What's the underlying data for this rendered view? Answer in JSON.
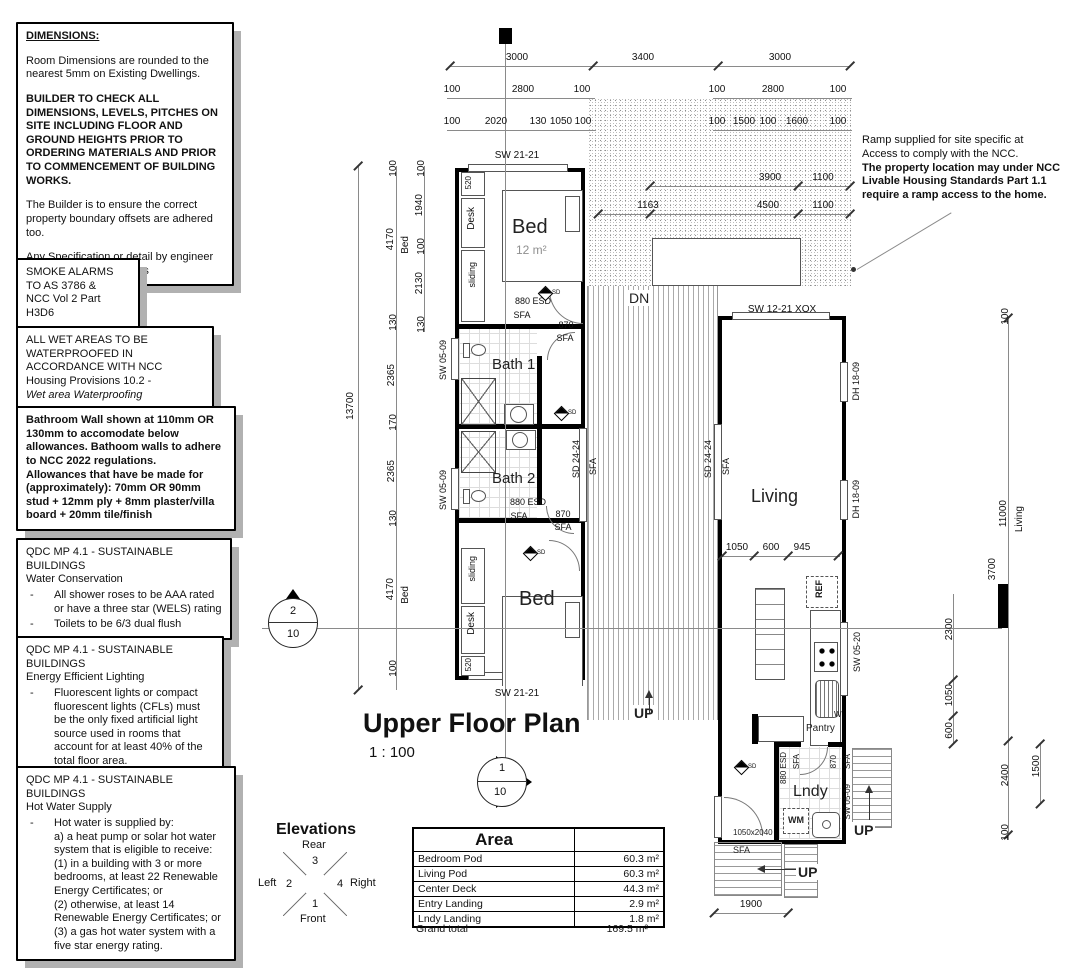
{
  "notes": {
    "bullet": "-",
    "dimensions": {
      "title": "DIMENSIONS:",
      "p1": "Room Dimensions are rounded to the nearest 5mm on Existing Dwellings.",
      "p2": "BUILDER TO CHECK ALL DIMENSIONS, LEVELS, PITCHES ON SITE INCLUDING FLOOR AND GROUND HEIGHTS PRIOR TO ORDERING MATERIALS AND PRIOR TO COMMENCEMENT OF BUILDING WORKS.",
      "p3": "The Builder is to ensure the correct property boundary offsets are adhered too.",
      "p4": "Any Specification or detail by engineer to supersede these plans"
    },
    "smoke": {
      "l1": "SMOKE ALARMS",
      "l2": "TO AS 3786 &",
      "l3": "NCC Vol 2 Part H3D6"
    },
    "wet": {
      "p1": "ALL WET AREAS TO BE WATERPROOFED IN ACCORDANCE WITH NCC Housing Provisions 10.2 -",
      "p2": "Wet area Waterproofing"
    },
    "bathwall": {
      "p1": "Bathroom Wall shown at 110mm OR 130mm to accomodate below allowances. Bathoom walls to adhere to NCC 2022 regulations.",
      "p2": "Allowances that have be made for (approximately): 70mm OR 90mm stud + 12mm ply + 8mm plaster/villa board + 20mm tile/finish"
    },
    "water": {
      "title": "QDC MP 4.1 - SUSTAINABLE BUILDINGS",
      "subtitle": "Water Conservation",
      "b1": "All shower roses to be AAA rated or have a three star (WELS) rating",
      "b2": "Toilets to be 6/3 dual flush"
    },
    "lighting": {
      "title": "QDC MP 4.1 - SUSTAINABLE BUILDINGS",
      "subtitle": "Energy Efficient Lighting",
      "b1": "Fluorescent lights or compact fluorescent lights (CFLs) must be the only fixed artificial light source used in rooms that account for at least 40% of the total floor area."
    },
    "hotwater": {
      "title": "QDC MP 4.1 - SUSTAINABLE BUILDINGS",
      "subtitle": "Hot Water Supply",
      "b1": "Hot water is supplied by:",
      "b2": "a) a heat pump or solar hot water system that is eligible to receive:",
      "b3": "(1) in a building with 3 or more bedrooms, at least 22 Renewable Energy Certificates; or",
      "b4": "(2) otherwise, at least 14 Renewable Energy Certificates; or",
      "b5": "(3) a gas hot water system with a five star energy rating."
    },
    "ramp": {
      "l1": "Ramp supplied for site specific at",
      "l2": "Access to comply with the NCC.",
      "l3": "The property location may under NCC",
      "l4": "Livable Housing Standards Part 1.1",
      "l5": "require a ramp access to the home."
    }
  },
  "title_block": {
    "title": "Upper Floor Plan",
    "scale": "1 : 100"
  },
  "elevations": {
    "title": "Elevations",
    "rear": "Rear",
    "front": "Front",
    "left": "Left",
    "right": "Right",
    "n1": "1",
    "n2": "2",
    "n3": "3",
    "n4": "4"
  },
  "area_table": {
    "header": "Area",
    "rows": [
      {
        "name": "Bedroom Pod",
        "value": "60.3 m²"
      },
      {
        "name": "Living Pod",
        "value": "60.3 m²"
      },
      {
        "name": "Center Deck",
        "value": "44.3 m²"
      },
      {
        "name": "Entry Landing",
        "value": "2.9 m²"
      },
      {
        "name": "Lndy Landing",
        "value": "1.8 m²"
      }
    ],
    "total_label": "Grand total",
    "total_value": "169.5 m²"
  },
  "markers": {
    "left_num": "2",
    "left_sheet": "10",
    "bottom_num": "1",
    "bottom_sheet": "10"
  },
  "labels": {
    "sw2121": "SW 21-21",
    "sw0509": "SW 05-09",
    "sw1221xox": "SW 12-21 XOX",
    "dh1809": "DH 18-09",
    "sw0520": "SW 05-20",
    "sd2424": "SD 24-24",
    "sfa": "SFA",
    "esd": "880 ESD",
    "d870": "870",
    "n520": "520",
    "door_lndy": "1050x2040",
    "dn": "DN",
    "up": "UP",
    "sd": "SD",
    "wm": "WM",
    "ref": "REF",
    "w": "W",
    "pantry": "Pantry",
    "desk": "Desk",
    "sliding": "sliding",
    "bed": "Bed",
    "bed_area": "12 m²",
    "bath1": "Bath 1",
    "bath2": "Bath 2",
    "living": "Living",
    "lndy": "Lndy"
  },
  "dims": {
    "top1": [
      "3000",
      "3400",
      "3000"
    ],
    "top2l": [
      "100",
      "2800",
      "100"
    ],
    "top2r": [
      "100",
      "2800",
      "100"
    ],
    "top3l": [
      "100",
      "2020",
      "130",
      "1050",
      "100"
    ],
    "top3r": [
      "100",
      "1500",
      "100",
      "1600",
      "100"
    ],
    "deck1": [
      "3900",
      "1100"
    ],
    "deck2": [
      "1163",
      "4500",
      "1100"
    ],
    "left_total": "13700",
    "left_mid": [
      "100",
      "4170",
      "130",
      "2365",
      "170",
      "2365",
      "130",
      "4170",
      "100"
    ],
    "left_bed": "Bed",
    "left_inner": [
      "100",
      "1940",
      "100",
      "2130",
      "130"
    ],
    "living_row": [
      "1050",
      "600",
      "945"
    ],
    "right_main": [
      "100",
      "11000",
      "2400",
      "100"
    ],
    "right_living": "Living",
    "right_bar": "3700",
    "right_inner": [
      "2300",
      "1050",
      "600"
    ],
    "right_1500": "1500",
    "bottom_1900": "1900"
  }
}
